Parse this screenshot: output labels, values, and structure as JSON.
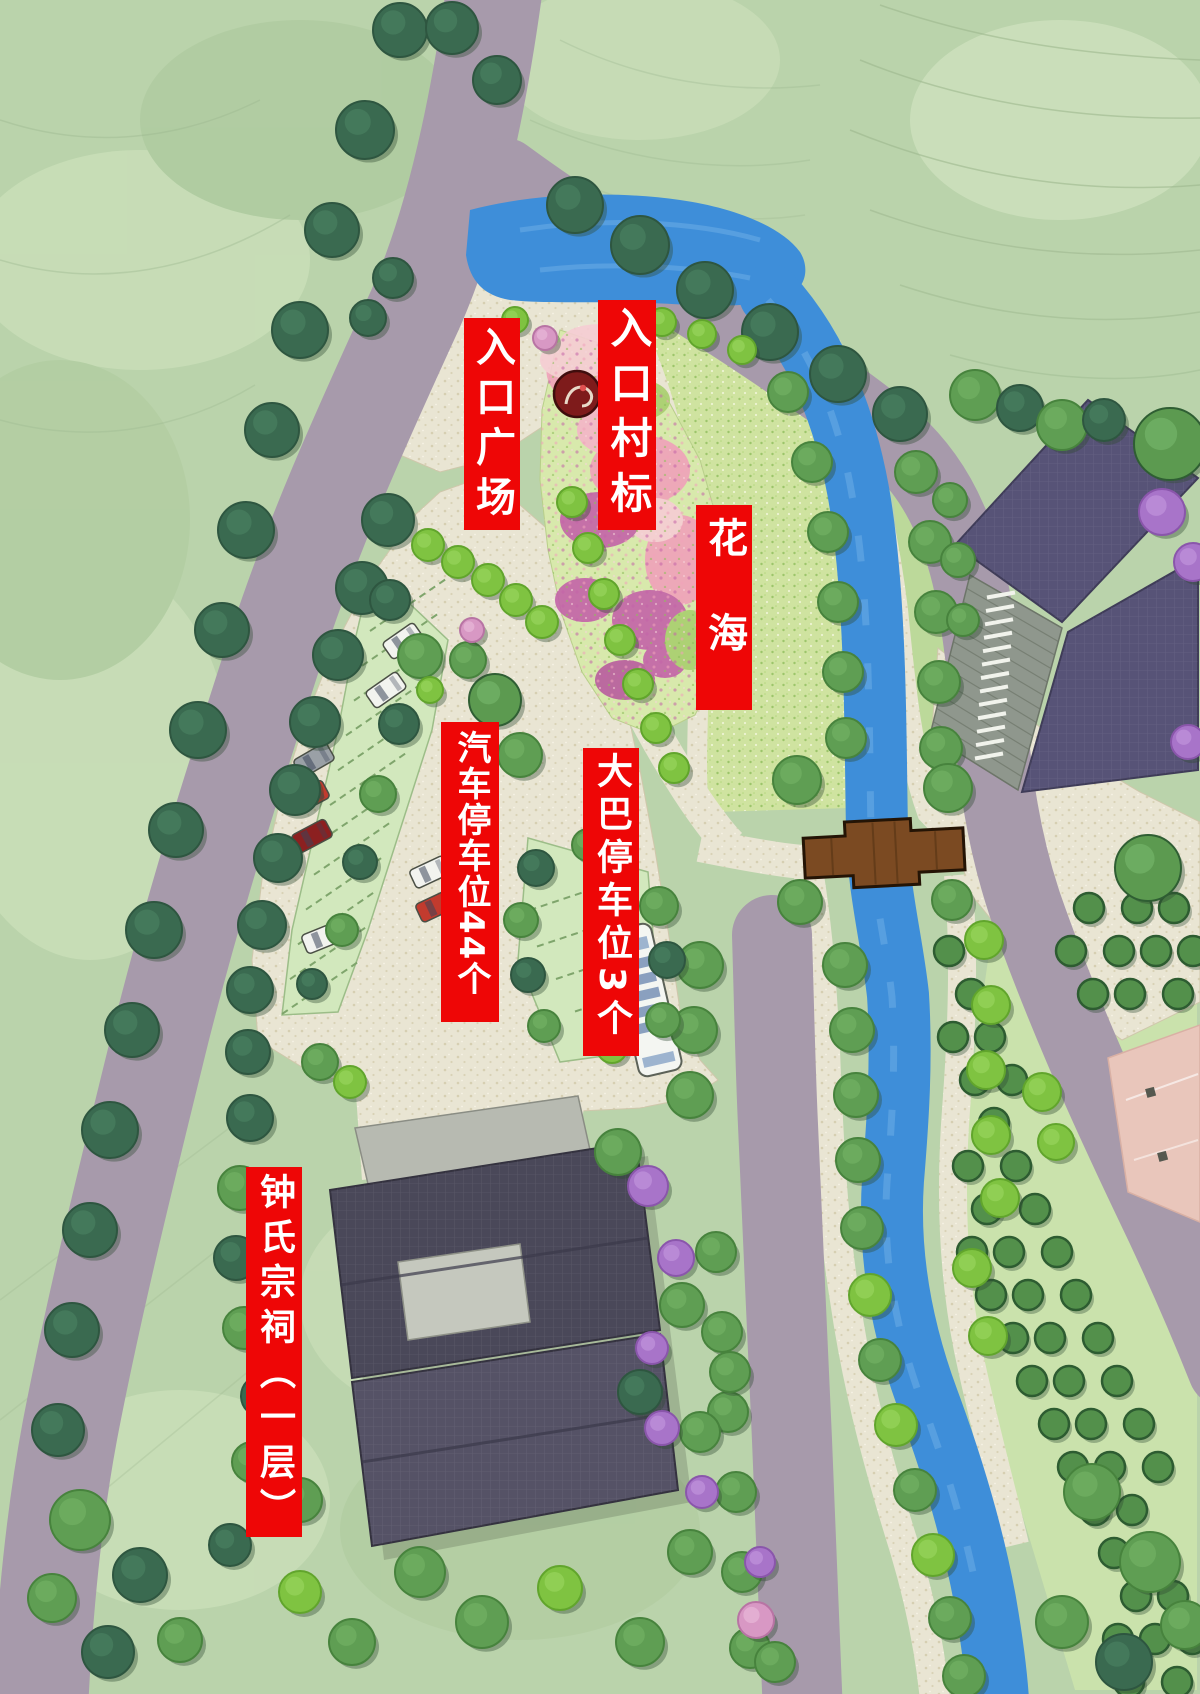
{
  "labels": {
    "entrance_plaza": "入口广场",
    "village_marker": "入口村标",
    "flower_sea": "花海",
    "car_parking": "汽车停车位44个",
    "bus_parking": "大巴停车位3个",
    "ancestral_hall": "钟氏宗祠（一层）"
  },
  "icons": {
    "village_marker": "red-seal-circle-icon",
    "bridge": "wooden-bridge",
    "bus": "bus-top-view",
    "car": "car-top-view"
  },
  "colors": {
    "banner_red": "#ee0606",
    "banner_text": "#ffffff",
    "background": "#bad3ab",
    "road": "#a79aab",
    "river": "#3e8ed9",
    "path_beige": "#e9e5d3",
    "flower_pink": "#f0a2ba",
    "flower_magenta": "#c363a8",
    "bridge_brown": "#7b4a22",
    "roof_dark": "#4a4859",
    "roof_purple": "#575377",
    "court_pink": "#e9c6bb",
    "parking_green": "#d2e8bd",
    "tree_dark": "#3a6a50",
    "tree_bright": "#7fc341"
  }
}
